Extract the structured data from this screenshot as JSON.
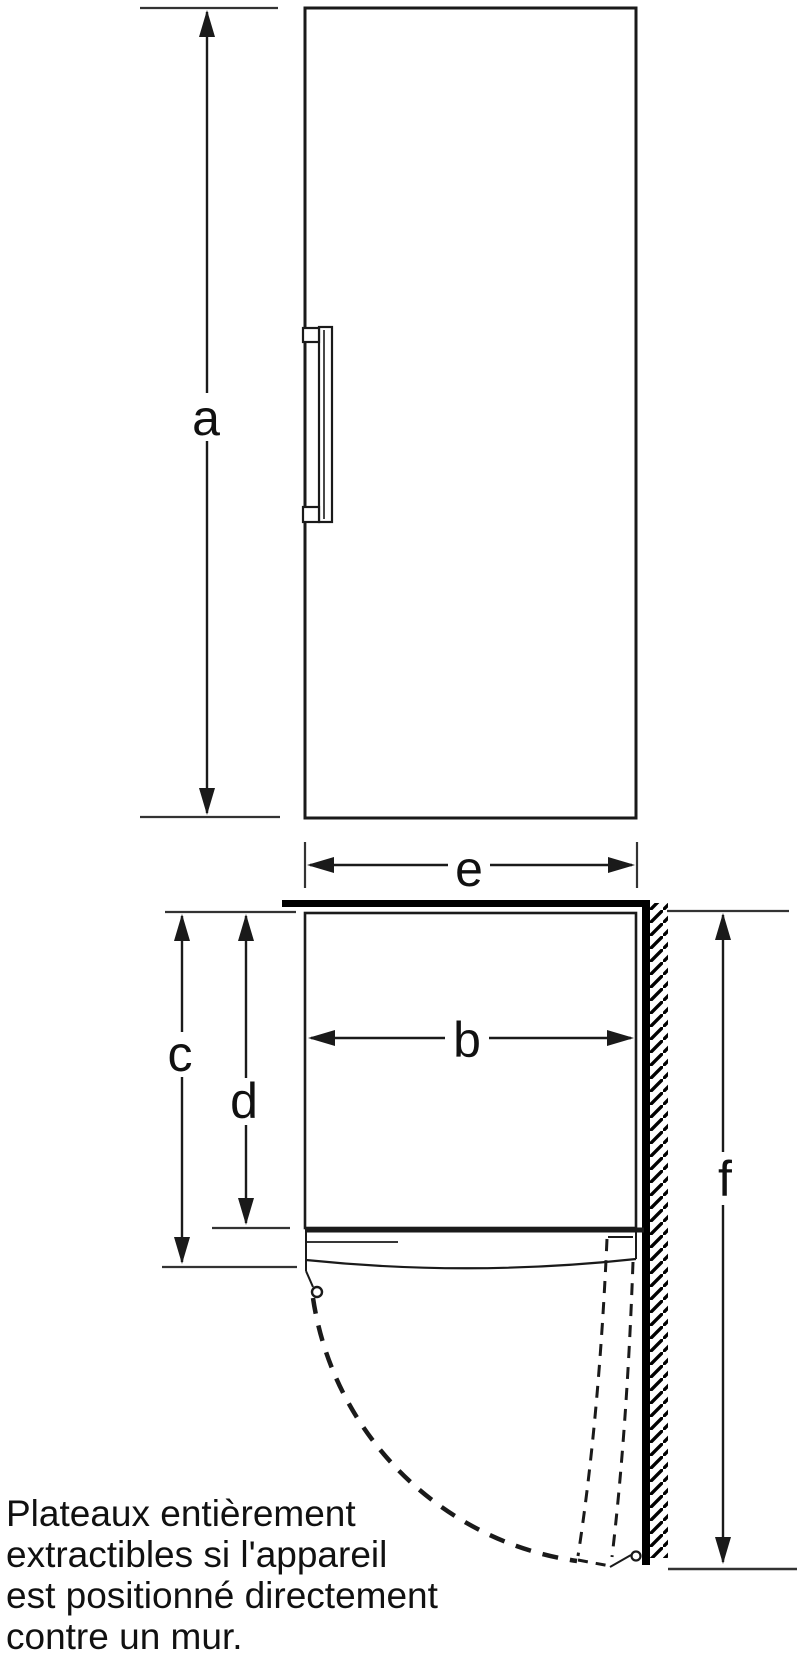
{
  "dimension_labels": {
    "a": "a",
    "b": "b",
    "c": "c",
    "d": "d",
    "e": "e",
    "f": "f"
  },
  "caption": {
    "text": "Plateaux entièrement\nextractibles si l'appareil\nest positionné directement\ncontre un mur."
  },
  "colors": {
    "line": "#1a1a1a",
    "wall": "#000000",
    "extension_line": "#333333",
    "background": "#ffffff"
  }
}
